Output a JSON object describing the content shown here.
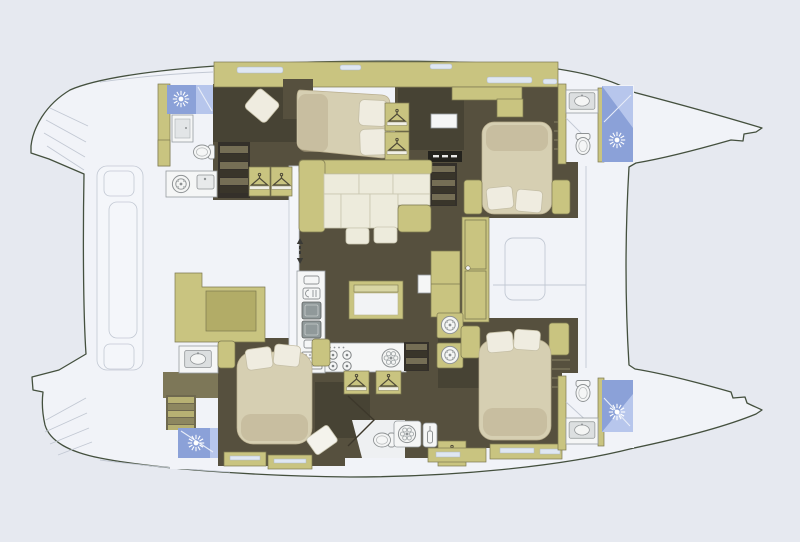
{
  "plan": {
    "type": "catamaran-yacht-deck-plan",
    "text_labels": []
  },
  "palette": {
    "bg": "#e6e9f0",
    "deck": "#f1f3f8",
    "deck2": "#f4f6fa",
    "outline": "#44503e",
    "seam": "#c2c8d3",
    "floor": "#56503e",
    "floor-dark": "#3d382b",
    "floor-aft": "#7d7758",
    "olive": "#c9c480",
    "olive-dark": "#b2ac67",
    "olive-light": "#d9d6a4",
    "olive-edge": "#7c7850",
    "bed": "#d6cfb2",
    "bed-shadow": "#b9ae8e",
    "pillow": "#efece0",
    "pillow-edge": "#c5bfa6",
    "cushion": "#edebdc",
    "cushion-edge": "#c9c6b0",
    "shower": "#8ba1d8",
    "shower-light": "#b7c6ec",
    "white": "#f5f6f6",
    "white-edge": "#979da0",
    "gray": "#9b9fa0",
    "window": "#dfe7f2",
    "black": "#23221d"
  },
  "icons": [
    "shower-sun-icon",
    "toilet-icon",
    "washbasin-icon",
    "washing-machine-icon",
    "clothes-hanger-icon",
    "stove-burner-icon",
    "large-burner-icon",
    "oven-icon",
    "galley-sink-icon",
    "wine-bottle-icon",
    "stairs-icon",
    "companionway-arrow-icon"
  ]
}
